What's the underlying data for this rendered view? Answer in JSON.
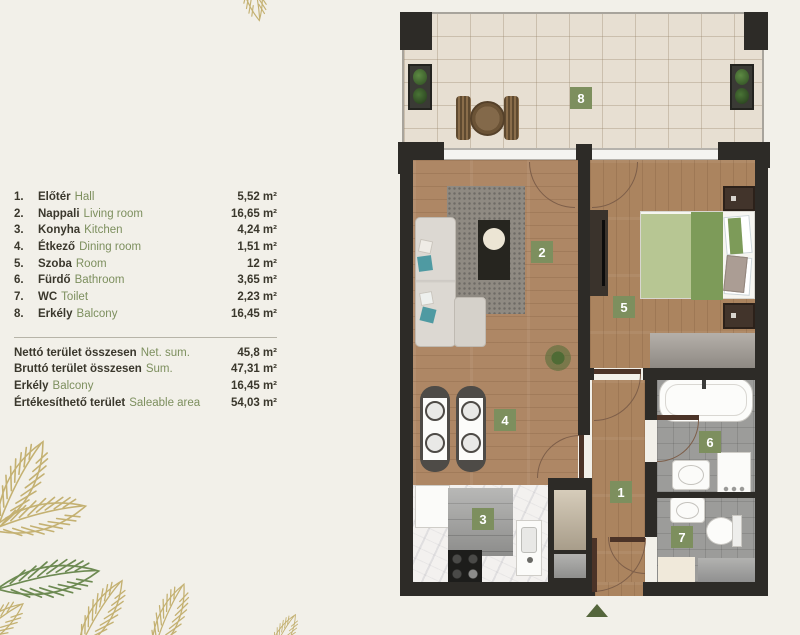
{
  "colors": {
    "background": "#f2f0e9",
    "text_dark": "#3a372c",
    "text_green": "#7d8f5e",
    "badge_green": "#7d8f5e",
    "arrow_green": "#55663c",
    "leaf_gold": "#c4b172",
    "leaf_green": "#6d8a52",
    "wall_dark": "#2d2b27"
  },
  "legend": {
    "rooms": [
      {
        "num": "1.",
        "hu": "Előtér",
        "en": "Hall",
        "area": "5,52 m²"
      },
      {
        "num": "2.",
        "hu": "Nappali",
        "en": "Living room",
        "area": "16,65 m²"
      },
      {
        "num": "3.",
        "hu": "Konyha",
        "en": "Kitchen",
        "area": "4,24 m²"
      },
      {
        "num": "4.",
        "hu": "Étkező",
        "en": "Dining room",
        "area": "1,51 m²"
      },
      {
        "num": "5.",
        "hu": "Szoba",
        "en": "Room",
        "area": "12 m²"
      },
      {
        "num": "6.",
        "hu": "Fürdő",
        "en": "Bathroom",
        "area": "3,65 m²"
      },
      {
        "num": "7.",
        "hu": "WC",
        "en": "Toilet",
        "area": "2,23 m²"
      },
      {
        "num": "8.",
        "hu": "Erkély",
        "en": "Balcony",
        "area": "16,45 m²"
      }
    ],
    "summary": [
      {
        "hu": "Nettó terület összesen",
        "en": "Net. sum.",
        "area": "45,8 m²"
      },
      {
        "hu": "Bruttó terület összesen",
        "en": "Sum.",
        "area": "47,31 m²"
      },
      {
        "hu": "Erkély",
        "en": "Balcony",
        "area": "16,45 m²"
      },
      {
        "hu": "Értékesíthető terület",
        "en": "Saleable area",
        "area": "54,03 m²"
      }
    ]
  },
  "plan": {
    "badges": [
      {
        "label": "1"
      },
      {
        "label": "2"
      },
      {
        "label": "3"
      },
      {
        "label": "4"
      },
      {
        "label": "5"
      },
      {
        "label": "6"
      },
      {
        "label": "7"
      },
      {
        "label": "8"
      }
    ]
  }
}
